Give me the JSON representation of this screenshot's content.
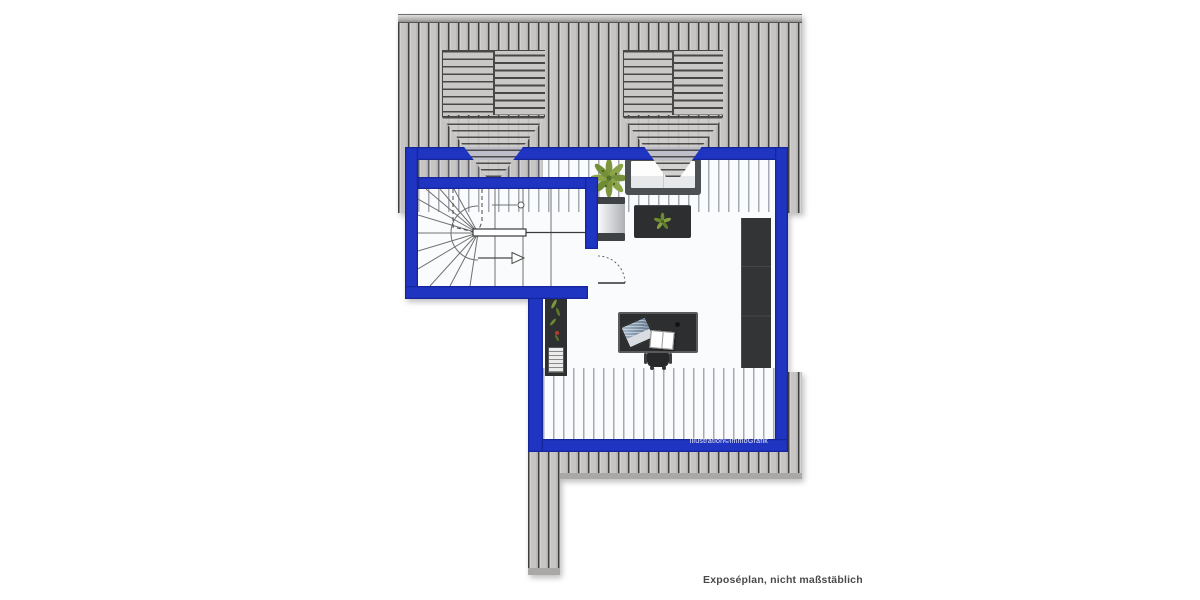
{
  "illustration": {
    "watermark": "Illustration©immoGrafik",
    "footnote": "Exposéplan, nicht maßstäblich"
  },
  "colors": {
    "wall_blue": "#1f34c0",
    "wall_blue_dark": "#15259c",
    "roof_base": "#c8c7c5",
    "roof_line": "#3f3f3f",
    "cap_gray": "#a9a8a6",
    "floor_white": "#fafbfd",
    "overlay_line": "#6e7380",
    "furniture_dark": "#313335",
    "sofa_frame": "#4d5052",
    "cushion_white": "#f4f5f6",
    "plant_green": "#7d953c",
    "accent_red": "#b3392e",
    "footnote_text": "#4a4a4a",
    "watermark_text": "#eef0f8"
  },
  "objects": [
    "pitched-roof",
    "roof-window",
    "roof-window",
    "winder-staircase",
    "door-swing",
    "sofa",
    "armchair",
    "coffee-table",
    "potted-plant",
    "wardrobe",
    "shelf-unit",
    "desk",
    "laptop",
    "open-book",
    "office-chair",
    "balcony",
    "terrace-strip"
  ]
}
